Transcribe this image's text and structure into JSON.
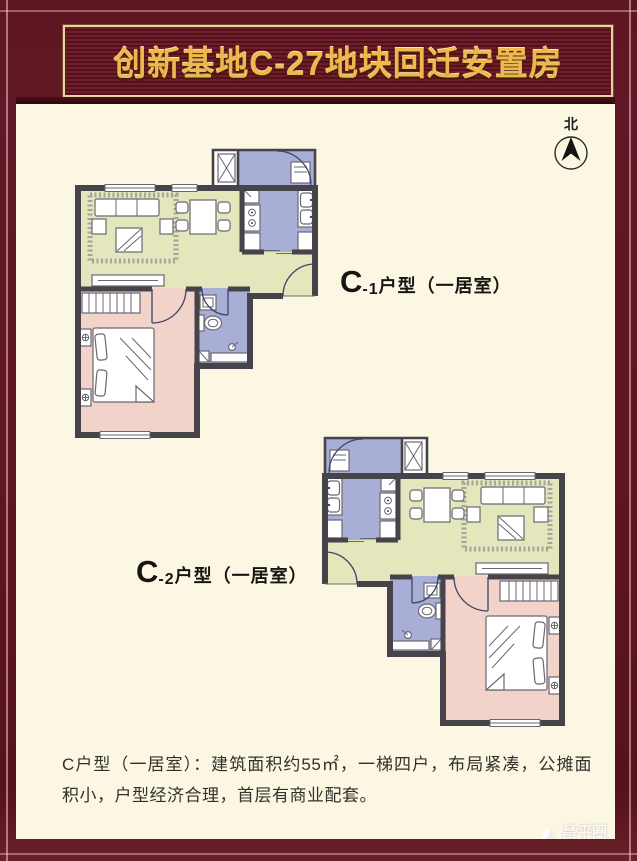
{
  "header": {
    "title": "创新基地C-27地块回迁安置房"
  },
  "compass": {
    "label": "北"
  },
  "plans": [
    {
      "main": "C",
      "sub": "-1",
      "rest": "户型（一居室）"
    },
    {
      "main": "C",
      "sub": "-2",
      "rest": "户型（一居室）"
    }
  ],
  "footer": {
    "description": "C户型（一居室）：建筑面积约55㎡，一梯四户，布局紧凑，公摊面积小，户型经济合理，首层有商业配套。"
  },
  "watermark": {
    "text": "昌平圈"
  },
  "colors": {
    "frame": "#5e1621",
    "banner_background": "#651724",
    "banner_border": "#e6d3a3",
    "banner_text": "#efb84f",
    "canvas": "#fbf7e3",
    "floor_living": "#e4e6bc",
    "floor_bedroom": "#f2d3c9",
    "floor_wet": "#a8aed5",
    "wall": "#46434b"
  }
}
